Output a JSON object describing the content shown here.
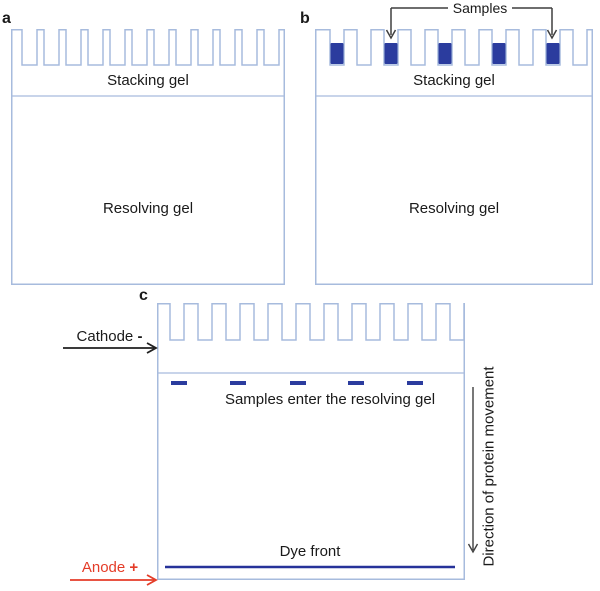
{
  "figure": {
    "panels": {
      "a": {
        "label": "a",
        "stacking": "Stacking gel",
        "resolving": "Resolving gel"
      },
      "b": {
        "label": "b",
        "stacking": "Stacking gel",
        "resolving": "Resolving gel",
        "samples": "Samples"
      },
      "c": {
        "label": "c",
        "samples_enter": "Samples enter the resolving gel",
        "dye_front": "Dye front",
        "cathode": "Cathode",
        "cathode_symbol": "-",
        "anode": "Anode",
        "anode_symbol": "+",
        "direction": "Direction of protein movement"
      }
    }
  },
  "colors": {
    "gel_outline": "#a7bbdd",
    "sample": "#2b3c9e",
    "dye_front": "#263299",
    "anode_red": "#e43c28",
    "annotation_black": "#1f1f1f",
    "bracket_gray": "#3f3f3f",
    "text": "#1a1a1a"
  },
  "gels": {
    "a": {
      "x": 11,
      "y": 29,
      "width": 274,
      "height": 256,
      "comb": {
        "margin": 11,
        "well_width": 15,
        "tooth_width": 7,
        "well_depth": 36,
        "wells": 12
      },
      "boundary_y": 67,
      "sample_wells": []
    },
    "b": {
      "x": 315,
      "y": 29,
      "width": 278,
      "height": 256,
      "comb": {
        "margin": 15,
        "well_width": 14,
        "tooth_width": 13,
        "well_depth": 36,
        "wells": 10
      },
      "boundary_y": 67,
      "sample_wells": [
        1,
        3,
        5,
        7,
        9
      ],
      "sample_top": 14,
      "sample_height": 21
    },
    "c": {
      "x": 157,
      "y": 303,
      "width": 308,
      "height": 277,
      "comb": {
        "margin": 13,
        "well_width": 14,
        "tooth_width": 14,
        "well_depth": 37,
        "wells": 11
      },
      "boundary_y": 70,
      "bands_x": [
        14,
        73,
        133,
        191,
        250
      ],
      "bands_y": 78,
      "band_width": 16,
      "band_height": 4,
      "dye_front_y": 264,
      "dye_front_x1": 8,
      "dye_front_x2": 298
    }
  },
  "annotations": {
    "samples_bracket": {
      "line_y": 8,
      "text_left": 448,
      "text_right": 512,
      "left_arrow_x": 391,
      "right_arrow_x": 552,
      "arrow_tip_y": 38
    },
    "cathode_arrow": {
      "x1": 63,
      "y": 348,
      "tip_x": 156
    },
    "anode_arrow": {
      "x1": 70,
      "y": 580,
      "tip_x": 156
    },
    "direction_arrow": {
      "x": 473,
      "y1": 387,
      "tip_y": 552
    }
  }
}
